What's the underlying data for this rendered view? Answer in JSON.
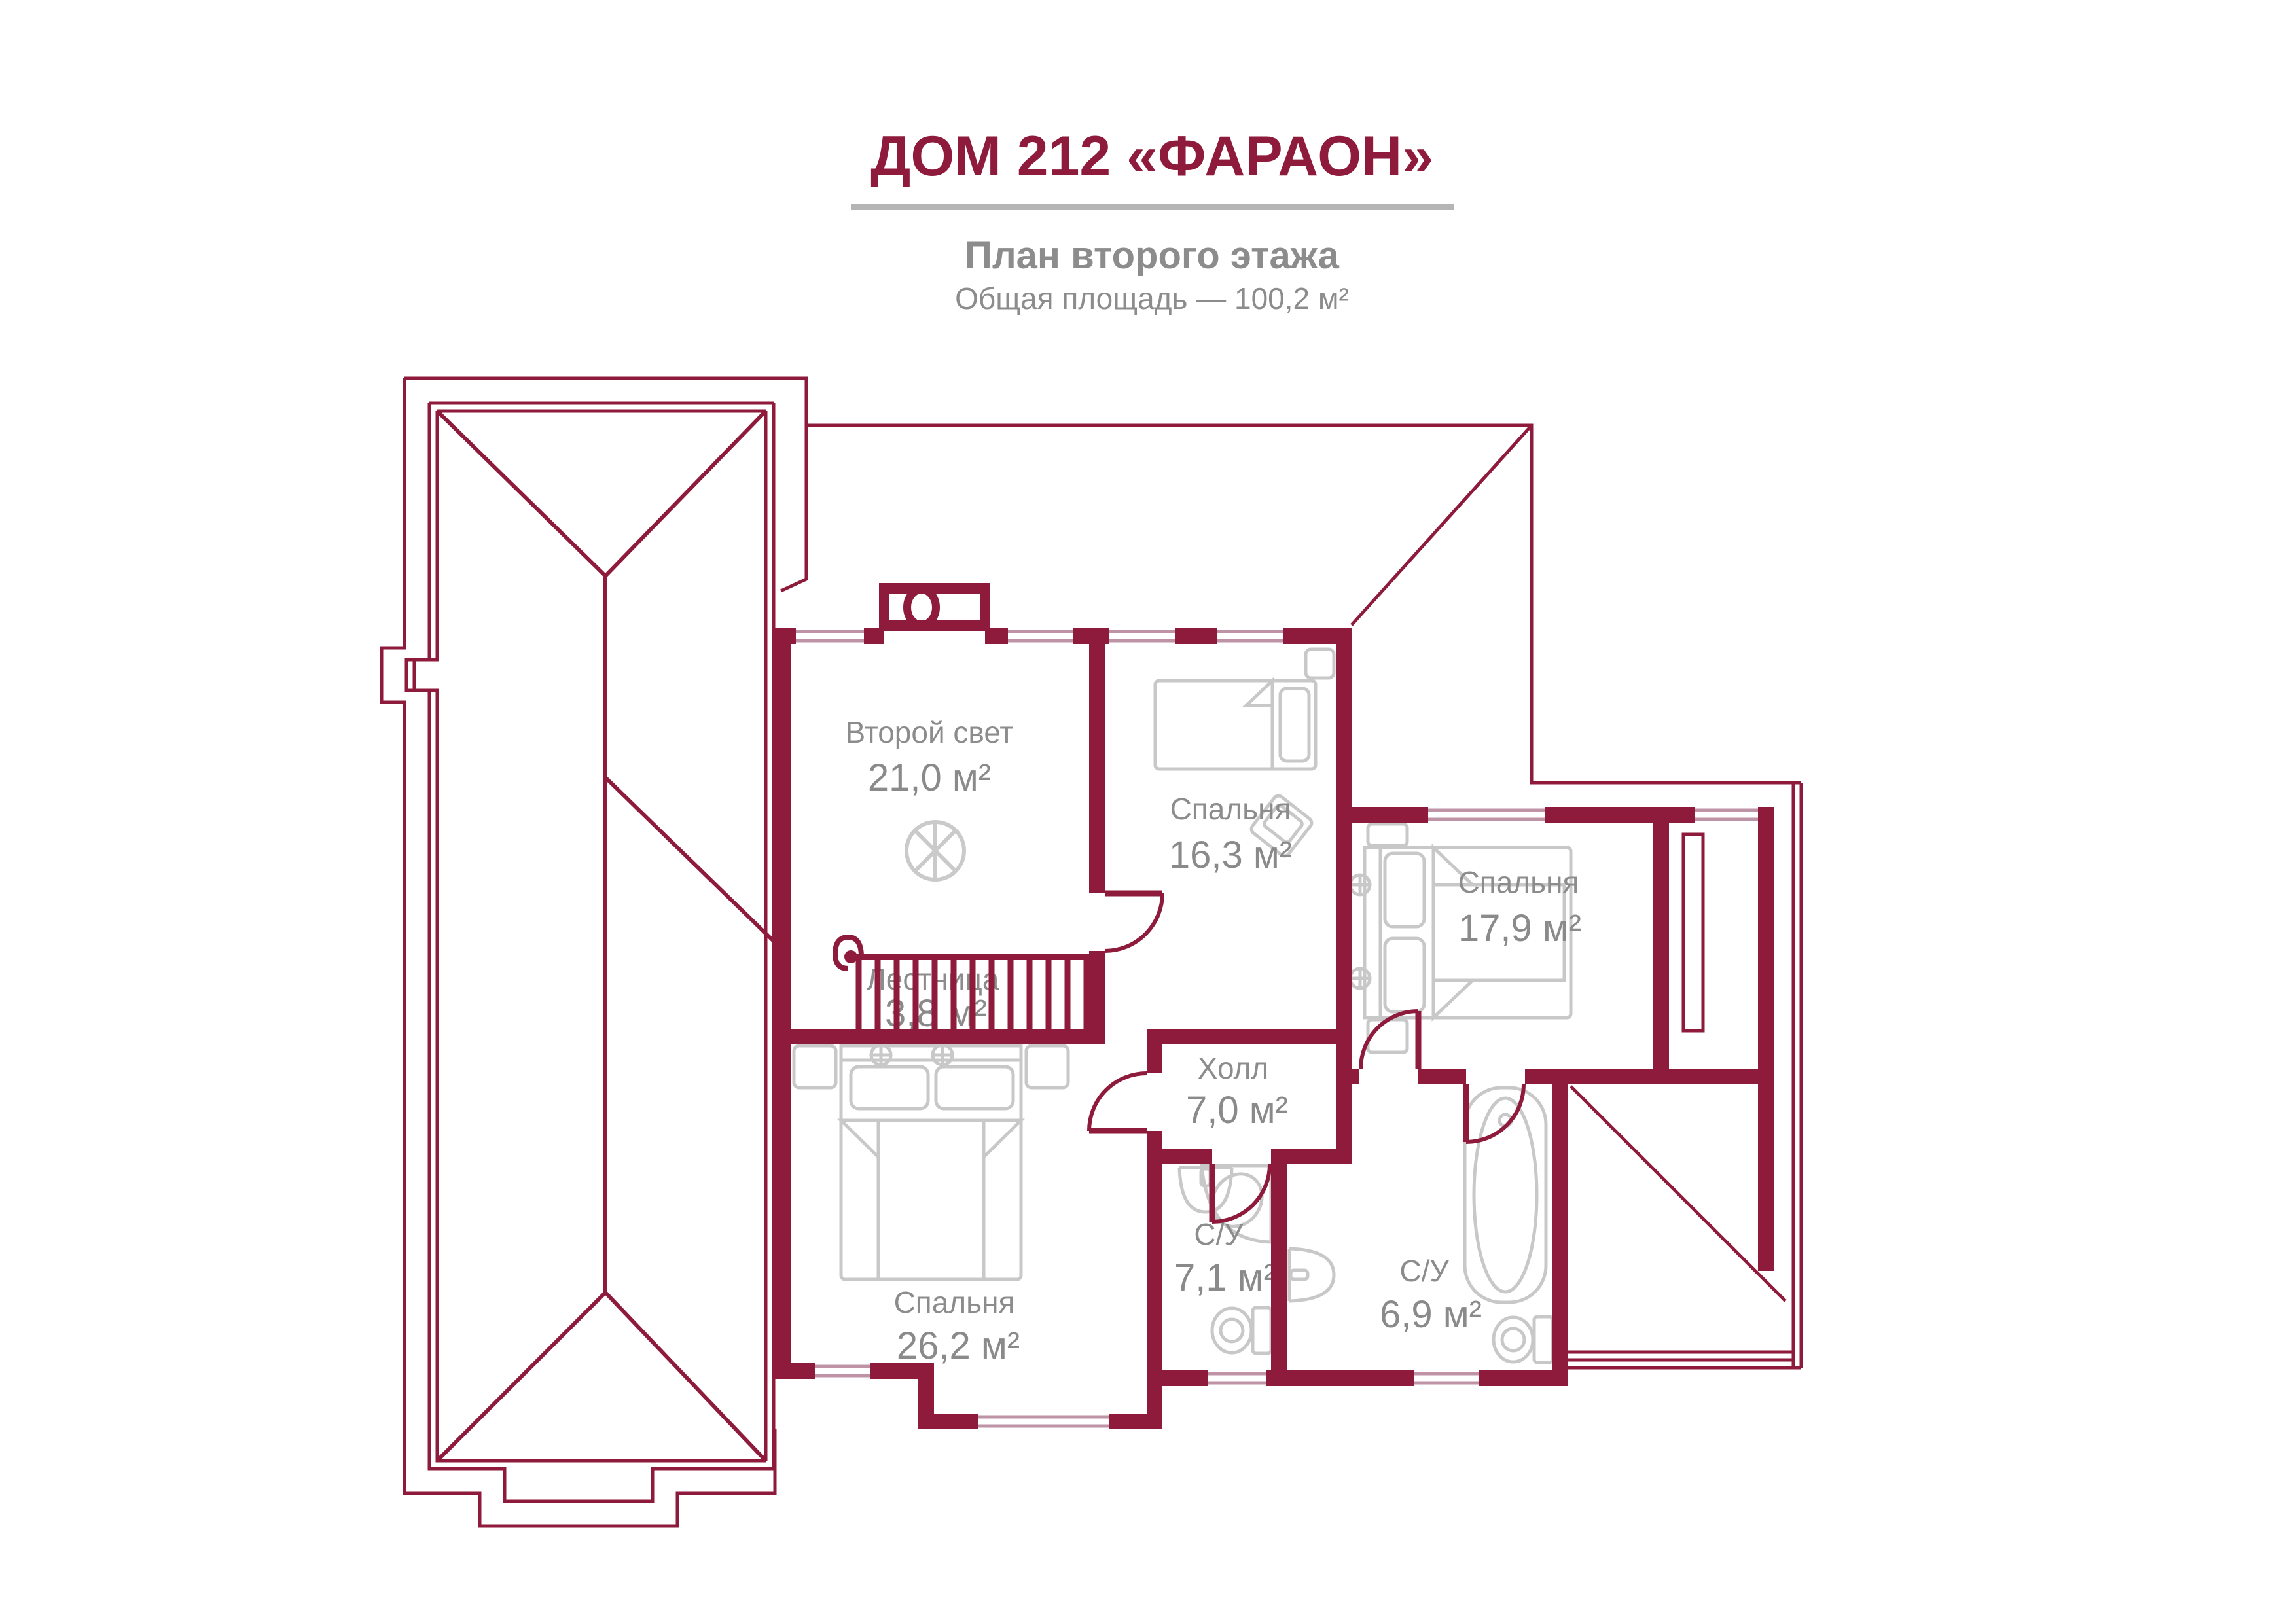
{
  "header": {
    "title": "ДОМ 212 «ФАРАОН»",
    "subtitle": "План второго этажа",
    "total_area": "Общая площадь — 100,2 м²"
  },
  "colors": {
    "wall": "#8e1a3c",
    "roof_line": "#8e1a3c",
    "window": "#be93a6",
    "furniture": "#c8c8c8",
    "label_gray": "#8c8c8c",
    "separator_gray": "#b5b5b5"
  },
  "rooms": {
    "second_light": {
      "name": "Второй свет",
      "area": "21,0 м²"
    },
    "bedroom_16": {
      "name": "Спальня",
      "area": "16,3 м²"
    },
    "bedroom_17": {
      "name": "Спальня",
      "area": "17,9 м²"
    },
    "stairs": {
      "name": "Лестница",
      "area": "3,8 м²"
    },
    "hall": {
      "name": "Холл",
      "area": "7,0 м²"
    },
    "bath_left": {
      "name": "С/У",
      "area": "7,1 м²"
    },
    "bath_right": {
      "name": "С/У",
      "area": "6,9 м²"
    },
    "bedroom_26": {
      "name": "Спальня",
      "area": "26,2 м²"
    }
  }
}
